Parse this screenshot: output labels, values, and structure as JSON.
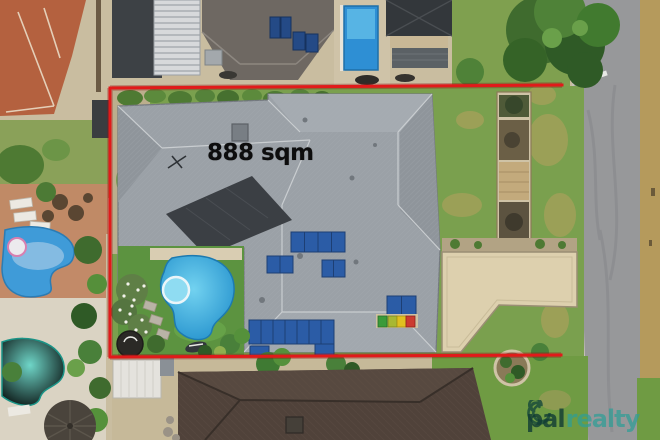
{
  "scene": {
    "area_label": "888 sqm",
    "watermark": {
      "logo_glyph": "spiral-O",
      "brand_prefix": "pal",
      "brand_suffix": "realty"
    },
    "boundary_color": "#e01a1a",
    "palette": {
      "subject_roof_gray": "#9ba1a7",
      "alfresco_shade_dark": "#3b3f44",
      "solar_panel_blue": "#2b5ca6",
      "terracotta_roof": "#b4613f",
      "brown_tile_roof": "#50423a",
      "pool_blue": "#2e9ad6",
      "pool_teal": "#2ab3a4",
      "driveway_cream": "#ddd0ae",
      "lawn_green": "#7aa04e",
      "dry_grass": "#b2a05e",
      "road_gray": "#97989a",
      "watermark_dark_green": "#113c34",
      "watermark_teal": "#2e9e96"
    }
  }
}
